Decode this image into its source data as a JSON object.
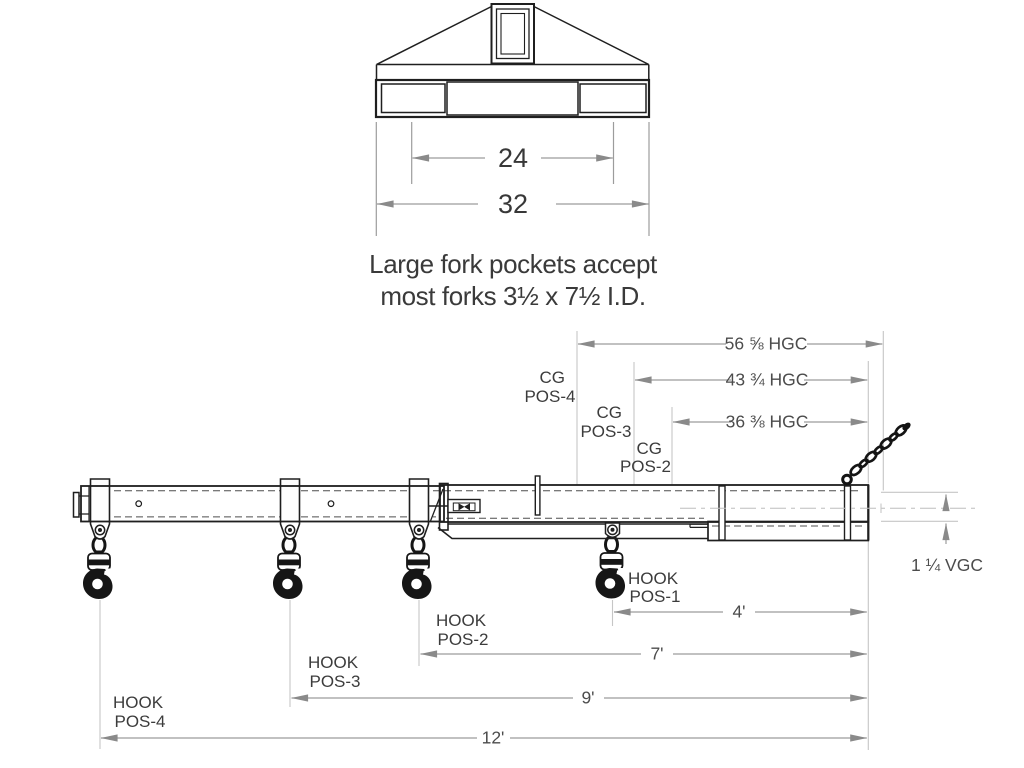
{
  "top_view": {
    "inner_pocket_spacing": "24",
    "overall_width": "32",
    "caption_line1": "Large fork pockets accept",
    "caption_line2": "most forks 3½ x 7½ I.D."
  },
  "side_view": {
    "cg_positions": [
      {
        "name_line1": "CG",
        "name_line2": "POS-4",
        "hgc_dimension": "56 ⅝ HGC"
      },
      {
        "name_line1": "CG",
        "name_line2": "POS-3",
        "hgc_dimension": "43 ¾ HGC"
      },
      {
        "name_line1": "CG",
        "name_line2": "POS-2",
        "hgc_dimension": "36 ⅜ HGC"
      }
    ],
    "hook_positions": [
      {
        "name_line1": "HOOK",
        "name_line2": "POS-1",
        "distance": "4'"
      },
      {
        "name_line1": "HOOK",
        "name_line2": "POS-2",
        "distance": "7'"
      },
      {
        "name_line1": "HOOK",
        "name_line2": "POS-3",
        "distance": "9'"
      },
      {
        "name_line1": "HOOK",
        "name_line2": "POS-4",
        "distance": "12'"
      }
    ],
    "vgc_dimension": "1 ¼ VGC"
  },
  "colors": {
    "background": "#ffffff",
    "linework": "#1f1f1f",
    "hook_black": "#161616",
    "dimension_line": "#9c9c9c",
    "extension_line": "#c6c6c6",
    "dimension_text": "#4c4c4c",
    "label_text": "#3c3c3c"
  }
}
